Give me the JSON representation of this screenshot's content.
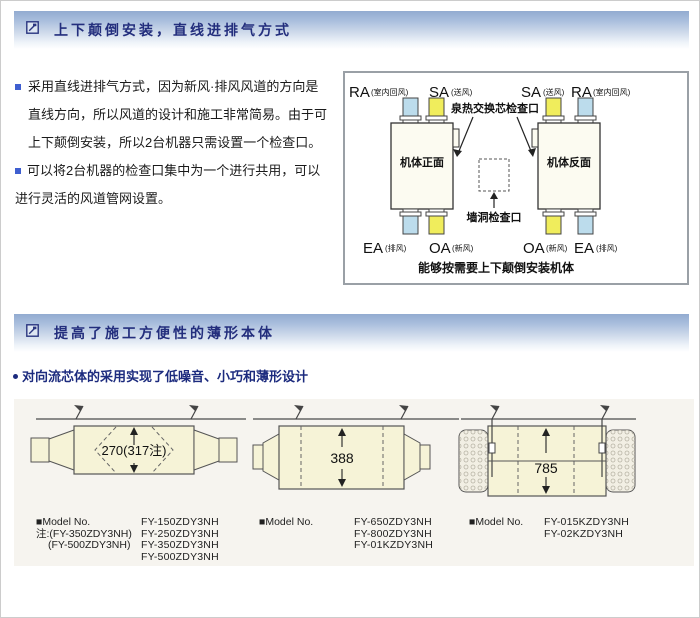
{
  "icons": {
    "header_icon": "boxed-arrow-icon",
    "bullet_square": "■",
    "feature_bullet": "●"
  },
  "colors": {
    "header_text": "#232e7d",
    "header_gradient_top": "#92abd0",
    "bullet_blue": "#3f5fd0",
    "feature_text": "#1c2b7e",
    "duct_blue": "#bcdcec",
    "duct_yellow": "#f0ed5c",
    "unit_fill": "#fcfbf1",
    "thin_body_fill": "#f6f3d7",
    "diagram_border": "#999999"
  },
  "section1": {
    "header": "上下颠倒安装，直线进排气方式",
    "bullets": [
      "采用直线进排气方式，因为新风·排风风道的方向是直线方向，所以风道的设计和施工非常简易。由于可上下颠倒安装，所以2台机器只需设置一个检查口。",
      "可以将2台机器的检查口集中为一个进行共用，可以进行灵活的风道管网设置。"
    ],
    "diagram": {
      "top_labels": [
        {
          "code": "RA",
          "sub": "(室内回风)"
        },
        {
          "code": "SA",
          "sub": "(送风)"
        },
        {
          "code": "SA",
          "sub": "(送风)"
        },
        {
          "code": "RA",
          "sub": "(室内回风)"
        }
      ],
      "core_inspection_label": "泉热交换芯检查口",
      "unit_front_label": "机体正面",
      "unit_back_label": "机体反面",
      "wall_inspection_label": "墙洞检查口",
      "bottom_labels": [
        {
          "code": "EA",
          "sub": "(排风)"
        },
        {
          "code": "OA",
          "sub": "(新风)"
        },
        {
          "code": "OA",
          "sub": "(新风)"
        },
        {
          "code": "EA",
          "sub": "(排风)"
        }
      ],
      "caption": "能够按需要上下颠倒安装机体"
    }
  },
  "section2": {
    "header": "提高了施工方便性的薄形本体",
    "feature": "对向流芯体的采用实现了低噪音、小巧和薄形设计",
    "diagrams": [
      {
        "dimension": "270(317注)"
      },
      {
        "dimension": "388"
      },
      {
        "dimension": "785"
      }
    ],
    "model_blocks": [
      {
        "label": "■Model No.",
        "models": [
          "FY-150ZDY3NH",
          "FY-250ZDY3NH",
          "FY-350ZDY3NH",
          "FY-500ZDY3NH"
        ],
        "notes": [
          "注:(FY-350ZDY3NH)",
          "(FY-500ZDY3NH)"
        ]
      },
      {
        "label": "■Model No.",
        "models": [
          "FY-650ZDY3NH",
          "FY-800ZDY3NH",
          "FY-01KZDY3NH"
        ],
        "notes": []
      },
      {
        "label": "■Model No.",
        "models": [
          "FY-015KZDY3NH",
          "FY-02KZDY3NH"
        ],
        "notes": []
      }
    ]
  }
}
